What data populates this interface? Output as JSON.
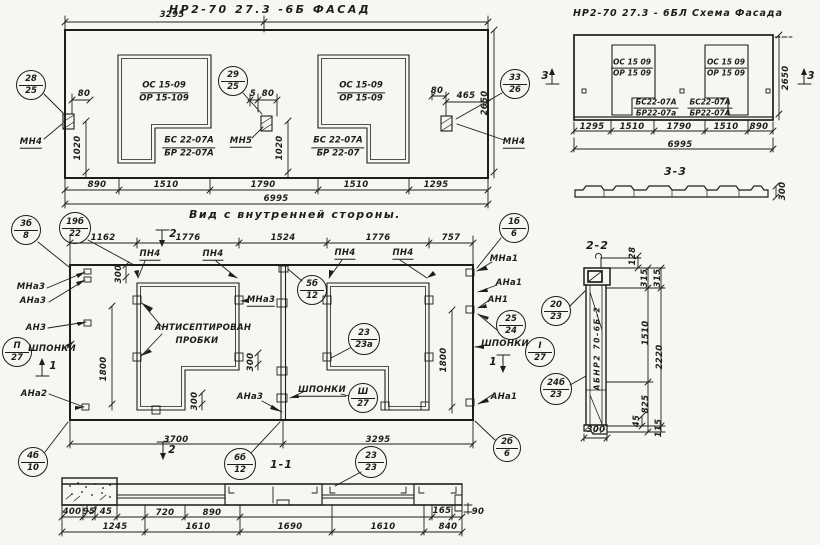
{
  "page": {
    "width": 820,
    "height": 545,
    "background": "#f7f6f1",
    "ink": "#1d1d1b"
  },
  "titles": {
    "fasad": "НР2-70 27.3 -6Б  ФАСАД",
    "schema": "НР2-70 27.3 - 6БЛ  Схема Фасада",
    "vid": "Вид с внутренней стороны.",
    "sec33": "3-3",
    "sec22": "2-2",
    "sec11": "1-1"
  },
  "annotations": {
    "labels": [
      {
        "t": "3295",
        "x": 172,
        "y": 15,
        "n": "dim-fasad-3295"
      },
      {
        "t": "890",
        "x": 97,
        "y": 185,
        "n": "dim-fasad-890"
      },
      {
        "t": "1510",
        "x": 166,
        "y": 185,
        "n": "dim-fasad-1510a"
      },
      {
        "t": "1790",
        "x": 263,
        "y": 185,
        "n": "dim-fasad-1790"
      },
      {
        "t": "1510",
        "x": 356,
        "y": 185,
        "n": "dim-fasad-1510b"
      },
      {
        "t": "1295",
        "x": 436,
        "y": 185,
        "n": "dim-fasad-1295"
      },
      {
        "t": "6995",
        "x": 276,
        "y": 199,
        "n": "dim-fasad-6995"
      },
      {
        "t": "80",
        "x": 84,
        "y": 94,
        "n": "dim-fasad-80a"
      },
      {
        "t": "1020",
        "x": 78,
        "y": 148,
        "v": 1,
        "n": "dim-fasad-1020a"
      },
      {
        "t": "5",
        "x": 253,
        "y": 94,
        "n": "dim-fasad-5"
      },
      {
        "t": "80",
        "x": 268,
        "y": 94,
        "n": "dim-fasad-80b"
      },
      {
        "t": "1020",
        "x": 280,
        "y": 148,
        "v": 1,
        "n": "dim-fasad-1020b"
      },
      {
        "t": "80",
        "x": 437,
        "y": 91,
        "n": "dim-fasad-80c"
      },
      {
        "t": "465",
        "x": 466,
        "y": 96,
        "n": "dim-fasad-465"
      },
      {
        "t": "2650",
        "x": 485,
        "y": 103,
        "v": 1,
        "n": "dim-fasad-2650"
      },
      {
        "t": "МН4",
        "x": 31,
        "y": 143,
        "u": 1,
        "n": "label-mn4-left"
      },
      {
        "t": "МН5",
        "x": 241,
        "y": 142,
        "u": 1,
        "n": "label-mn5"
      },
      {
        "t": "МН4",
        "x": 514,
        "y": 143,
        "u": 1,
        "n": "label-mn4-right"
      },
      {
        "t": "1295",
        "x": 592,
        "y": 127,
        "n": "dim-schema-1295"
      },
      {
        "t": "1510",
        "x": 632,
        "y": 127,
        "n": "dim-schema-1510a"
      },
      {
        "t": "1790",
        "x": 679,
        "y": 127,
        "n": "dim-schema-1790"
      },
      {
        "t": "1510",
        "x": 726,
        "y": 127,
        "n": "dim-schema-1510b"
      },
      {
        "t": "890",
        "x": 759,
        "y": 127,
        "n": "d im-schema-890"
      },
      {
        "t": "6995",
        "x": 680,
        "y": 145,
        "n": "dim-schema-6995"
      },
      {
        "t": "2650",
        "x": 786,
        "y": 78,
        "v": 1,
        "n": "dim-schema-2650"
      },
      {
        "t": "300",
        "x": 783,
        "y": 191,
        "v": 1,
        "n": "dim-sec33-300"
      },
      {
        "t": "3",
        "x": 545,
        "y": 76,
        "b": 1,
        "n": "section-mark-3-left"
      },
      {
        "t": "3",
        "x": 811,
        "y": 76,
        "b": 1,
        "n": "section-mark-3-right"
      },
      {
        "t": "1162",
        "x": 103,
        "y": 238,
        "n": "dim-vid-1162"
      },
      {
        "t": "1776",
        "x": 188,
        "y": 238,
        "n": "dim-vid-1776a"
      },
      {
        "t": "1524",
        "x": 283,
        "y": 238,
        "n": "dim-vid-1524"
      },
      {
        "t": "1776",
        "x": 378,
        "y": 238,
        "n": "dim-vid-1776b"
      },
      {
        "t": "757",
        "x": 451,
        "y": 238,
        "n": "dim-vid-757"
      },
      {
        "t": "2",
        "x": 173,
        "y": 234,
        "b": 1,
        "n": "section-mark-2-top"
      },
      {
        "t": "2",
        "x": 172,
        "y": 450,
        "b": 1,
        "n": "section-mark-2-bottom"
      },
      {
        "t": "1",
        "x": 53,
        "y": 366,
        "b": 1,
        "n": "section-mark-1-left"
      },
      {
        "t": "1",
        "x": 493,
        "y": 362,
        "b": 1,
        "n": "section-mark-1-right"
      },
      {
        "t": "ПН4",
        "x": 150,
        "y": 255,
        "u": 1,
        "n": "label-pn4-a"
      },
      {
        "t": "ПН4",
        "x": 213,
        "y": 255,
        "u": 1,
        "n": "label-pn4-b"
      },
      {
        "t": "ПН4",
        "x": 345,
        "y": 254,
        "u": 1,
        "n": "label-pn4-c"
      },
      {
        "t": "ПН4",
        "x": 403,
        "y": 254,
        "u": 1,
        "n": "label-pn4-d"
      },
      {
        "t": "МНа3",
        "x": 31,
        "y": 287,
        "n": "label-mna3-left"
      },
      {
        "t": "АНа3",
        "x": 33,
        "y": 301,
        "n": "label-ana3-left"
      },
      {
        "t": "АН3",
        "x": 36,
        "y": 328,
        "n": "label-an3"
      },
      {
        "t": "ШПОНКИ",
        "x": 52,
        "y": 349,
        "n": "label-shponki-left"
      },
      {
        "t": "АНа2",
        "x": 34,
        "y": 394,
        "n": "label-ana2"
      },
      {
        "t": "МНа1",
        "x": 504,
        "y": 259,
        "n": "label-mna1"
      },
      {
        "t": "АНа1",
        "x": 509,
        "y": 283,
        "n": "label-ana1-top"
      },
      {
        "t": "АН1",
        "x": 498,
        "y": 300,
        "n": "label-an1"
      },
      {
        "t": "ШПОНКИ",
        "x": 505,
        "y": 344,
        "n": "label-shponki-right"
      },
      {
        "t": "АНа1",
        "x": 504,
        "y": 397,
        "n": "label-ana1-bottom"
      },
      {
        "t": "МНа3",
        "x": 261,
        "y": 301,
        "u": 1,
        "n": "label-mna3-mid"
      },
      {
        "t": "АНТИСЕПТИРОВАН",
        "x": 203,
        "y": 328,
        "n": "label-antiseptirovan"
      },
      {
        "t": "ПРОБКИ",
        "x": 197,
        "y": 341,
        "n": "label-probki"
      },
      {
        "t": "ШПОНКИ",
        "x": 322,
        "y": 391,
        "u": 1,
        "n": "label-shponki-mid"
      },
      {
        "t": "АНа3",
        "x": 250,
        "y": 397,
        "n": "label-ana3-mid"
      },
      {
        "t": "300",
        "x": 119,
        "y": 274,
        "v": 1,
        "n": "dim-vid-300a"
      },
      {
        "t": "300",
        "x": 251,
        "y": 362,
        "v": 1,
        "n": "dim-vid-300b"
      },
      {
        "t": "300",
        "x": 195,
        "y": 401,
        "v": 1,
        "n": "dim-vid-300c"
      },
      {
        "t": "1800",
        "x": 104,
        "y": 369,
        "v": 1,
        "n": "dim-vid-1800-left"
      },
      {
        "t": "1800",
        "x": 444,
        "y": 360,
        "v": 1,
        "n": "dim-vid-1800-right"
      },
      {
        "t": "3700",
        "x": 176,
        "y": 440,
        "n": "dim-vid-3700"
      },
      {
        "t": "3295",
        "x": 378,
        "y": 440,
        "n": "dim-vid-3295"
      },
      {
        "t": "128",
        "x": 633,
        "y": 256,
        "v": 1,
        "n": "dim-sec22-128"
      },
      {
        "t": "315",
        "x": 645,
        "y": 278,
        "v": 1,
        "n": "dim-sec22-315a"
      },
      {
        "t": "315",
        "x": 658,
        "y": 278,
        "v": 1,
        "n": "dim-sec22-315b"
      },
      {
        "t": "1510",
        "x": 646,
        "y": 333,
        "v": 1,
        "n": "dim-sec22-1510"
      },
      {
        "t": "2220",
        "x": 660,
        "y": 357,
        "v": 1,
        "n": "dim-sec22-2220"
      },
      {
        "t": "825",
        "x": 646,
        "y": 404,
        "v": 1,
        "n": "dim-sec22-825"
      },
      {
        "t": "45",
        "x": 637,
        "y": 421,
        "v": 1,
        "n": "dim-sec22-45"
      },
      {
        "t": "115",
        "x": 659,
        "y": 428,
        "v": 1,
        "n": "dim-sec22-115"
      },
      {
        "t": "300",
        "x": 596,
        "y": 430,
        "n": "dim-sec22-300"
      },
      {
        "t": "АБНР2 70-6Б-2",
        "x": 597,
        "y": 348,
        "v": 1,
        "st": 1,
        "n": "stamp-abnr2-70-6b-2"
      },
      {
        "t": "400",
        "x": 72,
        "y": 512,
        "n": "dim-sec11-400"
      },
      {
        "t": "95",
        "x": 89,
        "y": 512,
        "n": "dim-sec11-95"
      },
      {
        "t": "45",
        "x": 106,
        "y": 512,
        "n": "dim-sec11-45"
      },
      {
        "t": "720",
        "x": 165,
        "y": 513,
        "n": "dim-sec11-720"
      },
      {
        "t": "890",
        "x": 212,
        "y": 513,
        "n": "dim-sec11-890"
      },
      {
        "t": "165",
        "x": 442,
        "y": 511,
        "n": "dim-sec11-165"
      },
      {
        "t": "90",
        "x": 478,
        "y": 512,
        "n": "dim-sec11-90"
      },
      {
        "t": "1245",
        "x": 115,
        "y": 527,
        "n": "dim-sec11-1245"
      },
      {
        "t": "1610",
        "x": 198,
        "y": 527,
        "n": "dim-sec11-1610a"
      },
      {
        "t": "1690",
        "x": 290,
        "y": 527,
        "n": "dim-sec11-1690"
      },
      {
        "t": "1610",
        "x": 383,
        "y": 527,
        "n": "dim-sec11-1610b"
      },
      {
        "t": "840",
        "x": 448,
        "y": 527,
        "n": "dim-sec11-840"
      }
    ],
    "fractions": [
      {
        "a": "ОС 15-09",
        "b": "ОР 15-109",
        "x": 164,
        "y": 92,
        "n": "mark-window1-os-or"
      },
      {
        "a": "БС 22-07А",
        "b": "БР 22-07А",
        "x": 189,
        "y": 147,
        "n": "mark-window1-bs-br"
      },
      {
        "a": "ОС 15-09",
        "b": "ОР 15-09",
        "x": 361,
        "y": 92,
        "n": "mark-window2-os-or"
      },
      {
        "a": "БС 22-07А",
        "b": "БР 22-07",
        "x": 338,
        "y": 147,
        "n": "mark-window2-bs-br"
      },
      {
        "a": "ОС 15 09",
        "b": "ОР 15 09",
        "x": 632,
        "y": 68,
        "s": 1,
        "n": "mark-schema-w1-os-or"
      },
      {
        "a": "ОС 15 09",
        "b": "ОР 15 09",
        "x": 726,
        "y": 68,
        "s": 1,
        "n": "mark-schema-w2-os-or"
      },
      {
        "a": "БС22-07А",
        "b": "БР22-07а",
        "x": 656,
        "y": 108,
        "s": 1,
        "n": "mark-schema-w1-bs-br"
      },
      {
        "a": "БС22-07А",
        "b": "БР22-07А",
        "x": 710,
        "y": 108,
        "s": 1,
        "n": "mark-schema-w2-bs-br"
      }
    ],
    "callouts": [
      {
        "a": "28",
        "b": "25",
        "x": 31,
        "y": 85,
        "r": 15,
        "n": "callout-28-25"
      },
      {
        "a": "29",
        "b": "25",
        "x": 233,
        "y": 81,
        "r": 15,
        "n": "callout-29-25"
      },
      {
        "a": "33",
        "b": "26",
        "x": 515,
        "y": 84,
        "r": 15,
        "n": "callout-33-26"
      },
      {
        "a": "3б",
        "b": "8",
        "x": 26,
        "y": 230,
        "r": 15,
        "n": "callout-3b-8"
      },
      {
        "a": "19б",
        "b": "22",
        "x": 75,
        "y": 228,
        "r": 16,
        "n": "callout-19b-22"
      },
      {
        "a": "5б",
        "b": "12",
        "x": 312,
        "y": 290,
        "r": 15,
        "n": "callout-5b-12"
      },
      {
        "a": "23",
        "b": "23а",
        "x": 364,
        "y": 339,
        "r": 16,
        "n": "callout-23-23a"
      },
      {
        "a": "Ш",
        "b": "27",
        "x": 363,
        "y": 398,
        "r": 15,
        "n": "callout-iii-27"
      },
      {
        "a": "П",
        "b": "27",
        "x": 17,
        "y": 352,
        "r": 15,
        "n": "callout-ii-27"
      },
      {
        "a": "I",
        "b": "27",
        "x": 540,
        "y": 352,
        "r": 15,
        "n": "callout-i-27"
      },
      {
        "a": "25",
        "b": "24",
        "x": 511,
        "y": 325,
        "r": 15,
        "n": "callout-25-24"
      },
      {
        "a": "1б",
        "b": "6",
        "x": 514,
        "y": 228,
        "r": 15,
        "n": "callout-1b-6"
      },
      {
        "a": "2б",
        "b": "6",
        "x": 507,
        "y": 448,
        "r": 14,
        "n": "callout-2b-6"
      },
      {
        "a": "4б",
        "b": "10",
        "x": 33,
        "y": 462,
        "r": 15,
        "n": "callout-4b-10"
      },
      {
        "a": "6б",
        "b": "12",
        "x": 240,
        "y": 464,
        "r": 16,
        "n": "callout-6b-12"
      },
      {
        "a": "23",
        "b": "23",
        "x": 371,
        "y": 462,
        "r": 16,
        "n": "callout-23-23"
      },
      {
        "a": "20",
        "b": "23",
        "x": 556,
        "y": 311,
        "r": 15,
        "n": "callout-20-23"
      },
      {
        "a": "24б",
        "b": "23",
        "x": 556,
        "y": 389,
        "r": 16,
        "n": "callout-24b-23"
      }
    ]
  }
}
